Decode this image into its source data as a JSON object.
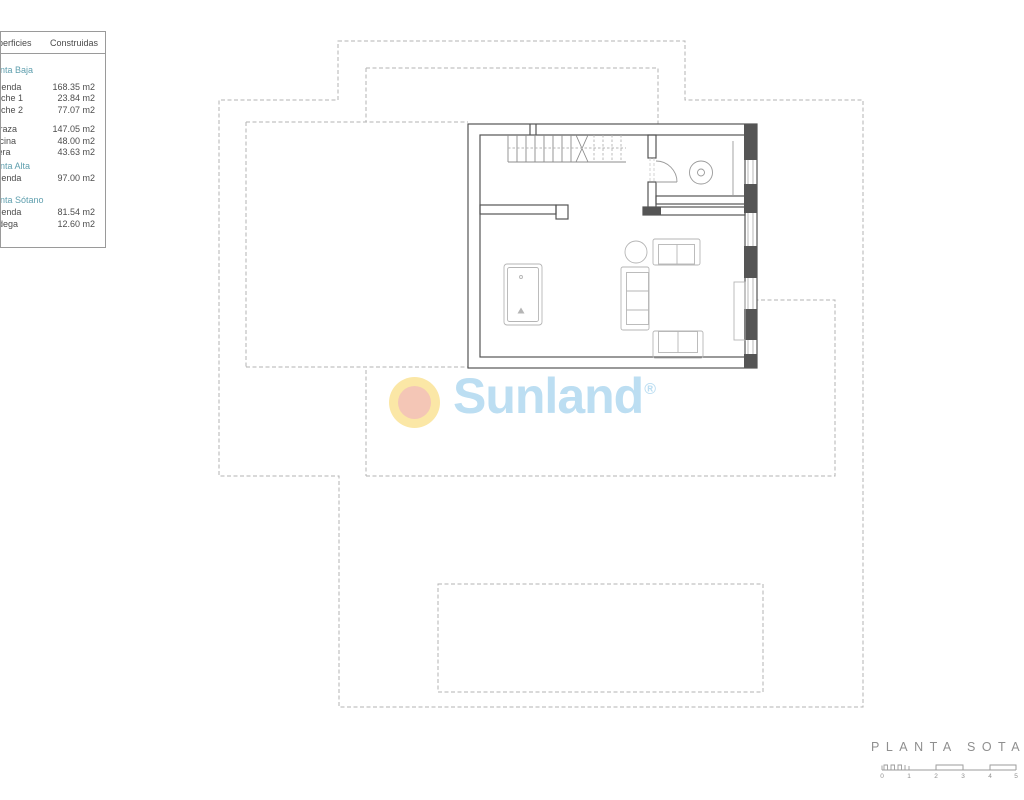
{
  "theme": {
    "teal_heading": "#5f9fae",
    "table_text": "#4d4d4d",
    "table_border": "#9a9a9a",
    "wall_line": "#555555",
    "dashed_line": "#b3b3b3",
    "furniture_line": "#b5b5b5",
    "stair_line": "#8c8c8c",
    "logo_text": "#bcdef2",
    "sun_outer": "#fbe7a6",
    "sun_inner": "#f4c6b6",
    "plan_label": "#8f8f8f"
  },
  "areas_table": {
    "col1_header": "Superficies",
    "col2_header": "Construidas",
    "rows": [
      {
        "type": "heading",
        "label": "Planta Baja"
      },
      {
        "type": "row",
        "label": "Vivienda",
        "value": "168.35 m2",
        "gap": 5
      },
      {
        "type": "row",
        "label": "Porche 1",
        "value": "23.84 m2"
      },
      {
        "type": "row",
        "label": "Porche 2",
        "value": "77.07 m2"
      },
      {
        "type": "row",
        "label": "Terraza",
        "value": "147.05 m2",
        "gap": 8
      },
      {
        "type": "row",
        "label": "Piscina",
        "value": "48.00 m2"
      },
      {
        "type": "row",
        "label": "Acera",
        "value": "43.63 m2"
      },
      {
        "type": "heading",
        "label": "Planta Alta",
        "gap": 1
      },
      {
        "type": "row",
        "label": "Vivienda",
        "value": "97.00 m2",
        "gap": 1
      },
      {
        "type": "heading",
        "label": "Planta Sótano",
        "gap": 9
      },
      {
        "type": "row",
        "label": "Vivienda",
        "value": "81.54 m2",
        "gap": 1
      },
      {
        "type": "row",
        "label": "Bodega",
        "value": "12.60 m2"
      }
    ]
  },
  "logo": {
    "brand": "Sunland",
    "registered_mark": "®"
  },
  "plan": {
    "label": "PLANTA SOTANO",
    "scale": {
      "ticks": [
        "0",
        "1",
        "2",
        "3",
        "4",
        "5"
      ]
    }
  }
}
